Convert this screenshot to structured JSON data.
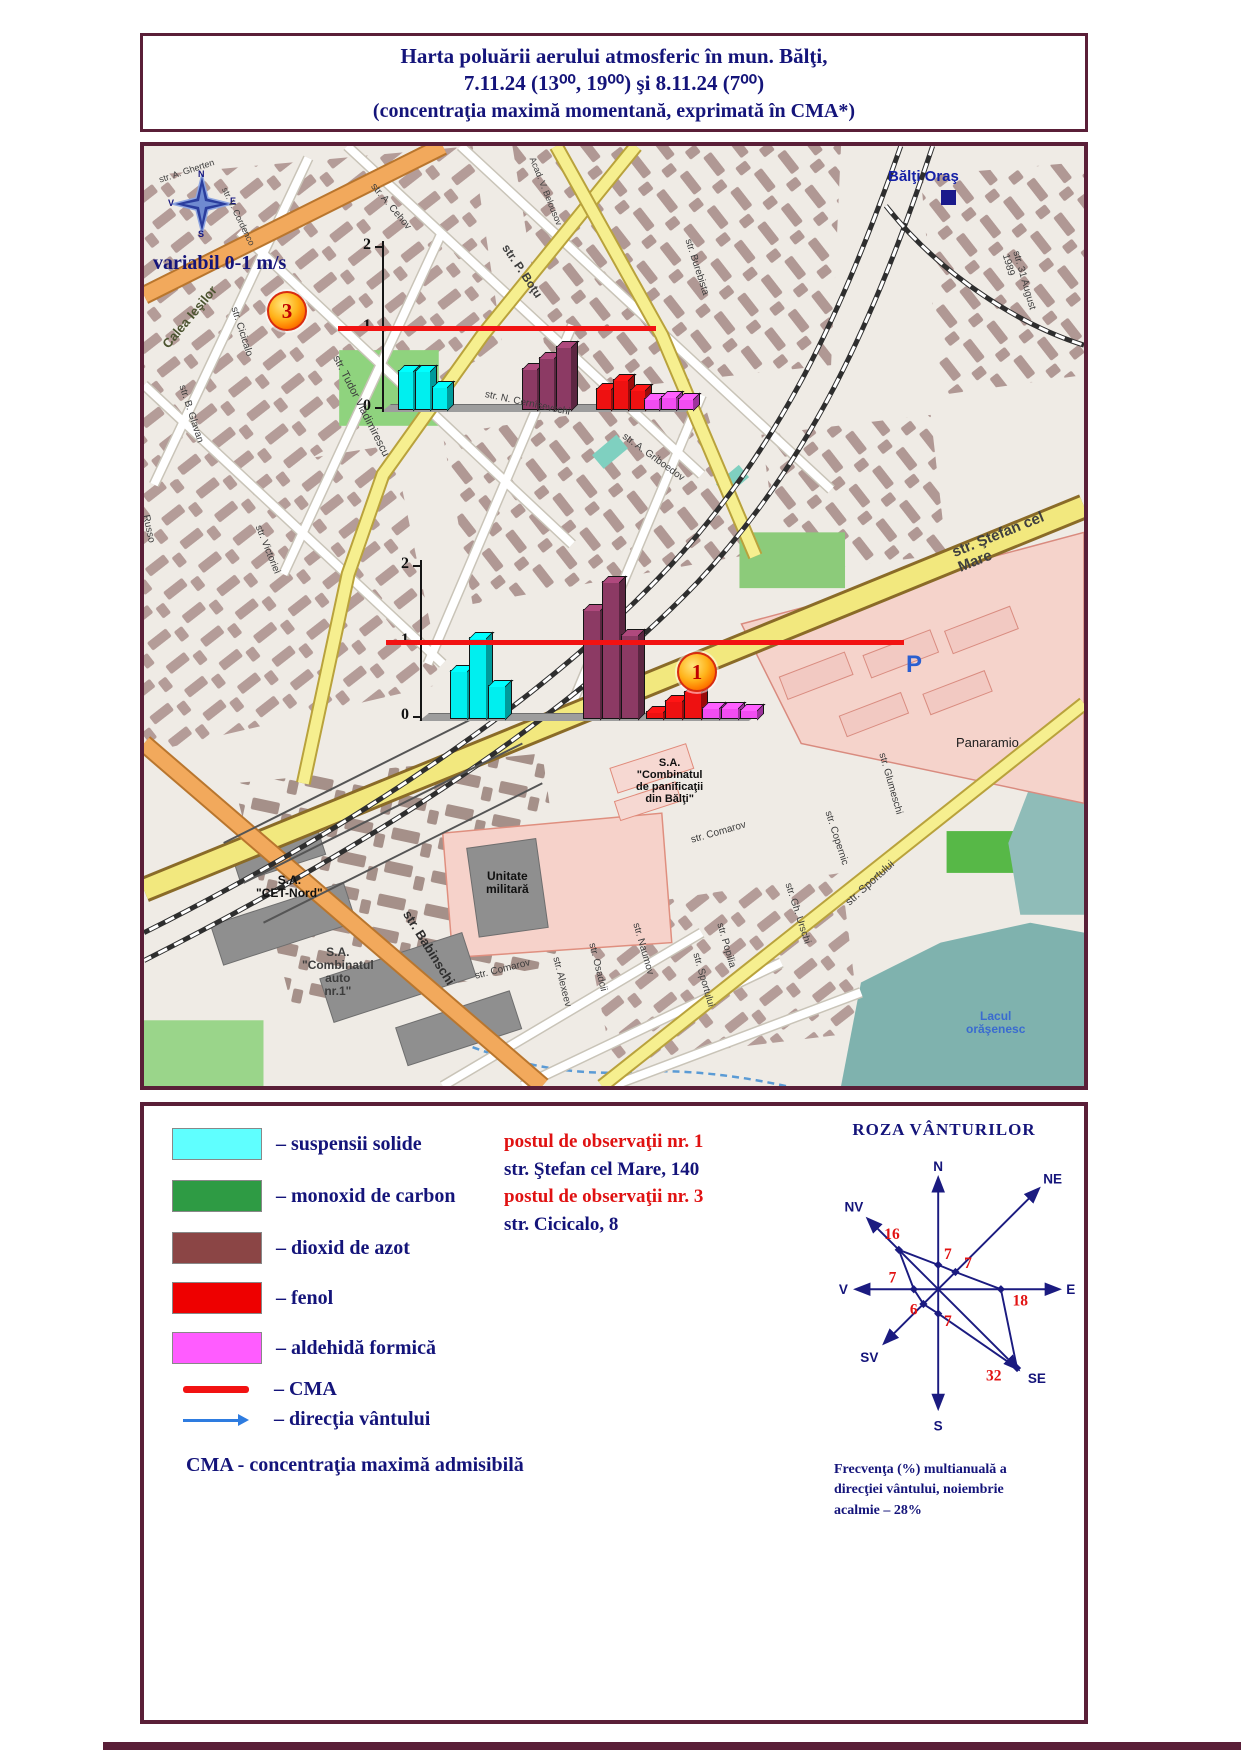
{
  "title": {
    "line1": "Harta poluării aerului atmosferic în mun. Bălţi,",
    "line2": "7.11.24  (13⁰⁰, 19⁰⁰) şi  8.11.24 (7⁰⁰)",
    "line3": "(concentraţia maximă momentană, exprimată în CMA*)"
  },
  "map": {
    "city_label": "Bălţi Oraş",
    "wind_note": "variabil 0-1 m/s",
    "compass": {
      "n": "N",
      "e": "E",
      "s": "S",
      "v": "V"
    },
    "stations": [
      {
        "id": "3",
        "x": 123,
        "y": 145
      },
      {
        "id": "1",
        "x": 533,
        "y": 506
      }
    ],
    "street_labels": [
      {
        "t": "str. A. Gherten",
        "x": 14,
        "y": 30,
        "r": -18,
        "s": 9
      },
      {
        "t": "str. V. Cordenco",
        "x": 84,
        "y": 40,
        "r": 64,
        "s": 9
      },
      {
        "t": "Calea Ieşilor",
        "x": 16,
        "y": 196,
        "r": -50,
        "s": 13,
        "b": 1,
        "c": "#4c5430"
      },
      {
        "t": "str. Cicicalo",
        "x": 94,
        "y": 160,
        "r": 72,
        "s": 10
      },
      {
        "t": "str. B. Glavan",
        "x": 42,
        "y": 238,
        "r": 72,
        "s": 10
      },
      {
        "t": "Russo",
        "x": 6,
        "y": 368,
        "r": 78,
        "s": 10
      },
      {
        "t": "str. Victoriei",
        "x": 118,
        "y": 378,
        "r": 68,
        "s": 10
      },
      {
        "t": "str. Tudor Vladimirescu",
        "x": 196,
        "y": 208,
        "r": 63,
        "s": 11
      },
      {
        "t": "str. A. Cehov",
        "x": 232,
        "y": 36,
        "r": 50,
        "s": 10
      },
      {
        "t": "Acad. V. Belousov",
        "x": 392,
        "y": 10,
        "r": 68,
        "s": 9
      },
      {
        "t": "str. P. Boţu",
        "x": 366,
        "y": 96,
        "r": 56,
        "s": 12,
        "b": 1
      },
      {
        "t": "str. Burebista",
        "x": 548,
        "y": 92,
        "r": 72,
        "s": 10
      },
      {
        "t": "str. A. Griboedov",
        "x": 482,
        "y": 286,
        "r": 36,
        "s": 10
      },
      {
        "t": "str. N. Cernîşevschi",
        "x": 342,
        "y": 244,
        "r": 12,
        "s": 10
      },
      {
        "t": "str. 31 August 1989",
        "x": 876,
        "y": 104,
        "r": 74,
        "s": 10
      },
      {
        "t": "str. Ştefan cel Mare",
        "x": 806,
        "y": 400,
        "r": -22,
        "s": 15,
        "b": 1,
        "c": "#3f3f3f"
      },
      {
        "t": "Panaramio",
        "x": 812,
        "y": 590,
        "r": 0,
        "s": 13,
        "c": "#1d1d1d"
      },
      {
        "t": "P",
        "x": 762,
        "y": 506,
        "r": 0,
        "s": 24,
        "b": 1,
        "c": "#2b5fd0"
      },
      {
        "t": "S.A.\n\"Combinatul\nde panificaţii\ndin Bălţi\"",
        "x": 492,
        "y": 612,
        "r": 0,
        "s": 11,
        "b": 1,
        "c": "#101010",
        "a": "c"
      },
      {
        "t": "Unitate\nmilitară",
        "x": 342,
        "y": 724,
        "r": 0,
        "s": 12,
        "b": 1,
        "c": "#101010",
        "a": "c"
      },
      {
        "t": "S.A.\n\"CET-Nord\"",
        "x": 112,
        "y": 728,
        "r": 0,
        "s": 12,
        "b": 1,
        "c": "#101010",
        "a": "c"
      },
      {
        "t": "str. Babinschi",
        "x": 268,
        "y": 762,
        "r": 58,
        "s": 13,
        "b": 1,
        "c": "#2e2e2e"
      },
      {
        "t": "S.A.\n\"Combinatul\nauto\nnr.1\"",
        "x": 158,
        "y": 800,
        "r": 0,
        "s": 12,
        "b": 1,
        "a": "c"
      },
      {
        "t": "str. Comarov",
        "x": 546,
        "y": 690,
        "r": -16,
        "s": 10
      },
      {
        "t": "str. Copernic",
        "x": 688,
        "y": 664,
        "r": 72,
        "s": 10
      },
      {
        "t": "str. Glumeschi",
        "x": 742,
        "y": 606,
        "r": 74,
        "s": 10
      },
      {
        "t": "str. Gh. Urschi",
        "x": 648,
        "y": 736,
        "r": 72,
        "s": 10
      },
      {
        "t": "str. Sportului",
        "x": 700,
        "y": 754,
        "r": -42,
        "s": 11
      },
      {
        "t": "str. Comarov",
        "x": 330,
        "y": 826,
        "r": -14,
        "s": 10
      },
      {
        "t": "str. Alexeev",
        "x": 416,
        "y": 810,
        "r": 76,
        "s": 10
      },
      {
        "t": "str. Osadcii",
        "x": 452,
        "y": 796,
        "r": 76,
        "s": 10
      },
      {
        "t": "str. Naumov",
        "x": 496,
        "y": 776,
        "r": 74,
        "s": 10
      },
      {
        "t": "str. Popilia",
        "x": 580,
        "y": 776,
        "r": 74,
        "s": 10
      },
      {
        "t": "str. Sportului",
        "x": 556,
        "y": 806,
        "r": 74,
        "s": 10
      },
      {
        "t": "Lacul\norăşenesc",
        "x": 822,
        "y": 864,
        "r": 0,
        "s": 12,
        "b": 1,
        "c": "#3a6bd0",
        "a": "c"
      }
    ]
  },
  "chart_data": [
    {
      "type": "bar",
      "station": "postul de observaţii nr. 3",
      "location": "str. Cicicalo, 8",
      "unit": "CMA",
      "ylim": [
        0,
        2
      ],
      "yticks": [
        0,
        1,
        2
      ],
      "cma_level": 1,
      "categories": [
        "7.11.24 13⁰⁰",
        "7.11.24 19⁰⁰",
        "8.11.24 7⁰⁰"
      ],
      "series": [
        {
          "name": "suspensii solide",
          "color": "#00EFEF",
          "values": [
            0.47,
            0.47,
            0.27
          ]
        },
        {
          "name": "dioxid de azot",
          "color": "#8C3A64",
          "values": [
            0.5,
            0.63,
            0.77
          ]
        },
        {
          "name": "fenol",
          "color": "#EE1111",
          "values": [
            0.25,
            0.36,
            0.24
          ]
        },
        {
          "name": "aldehidă formică",
          "color": "#F24DF2",
          "values": [
            0.12,
            0.15,
            0.12
          ]
        }
      ]
    },
    {
      "type": "bar",
      "station": "postul de observaţii nr. 1",
      "location": "str. Ştefan cel Mare, 140",
      "unit": "CMA",
      "ylim": [
        0,
        2
      ],
      "yticks": [
        0,
        1,
        2
      ],
      "cma_level": 1,
      "categories": [
        "7.11.24 13⁰⁰",
        "7.11.24 19⁰⁰",
        "8.11.24 7⁰⁰"
      ],
      "series": [
        {
          "name": "suspensii solide",
          "color": "#00EFEF",
          "values": [
            0.62,
            1.06,
            0.42
          ]
        },
        {
          "name": "dioxid de azot",
          "color": "#8C3A64",
          "values": [
            1.43,
            1.8,
            1.1
          ]
        },
        {
          "name": "fenol",
          "color": "#EE1111",
          "values": [
            0.08,
            0.22,
            0.35
          ]
        },
        {
          "name": "aldehidă formică",
          "color": "#F24DF2",
          "values": [
            0.13,
            0.13,
            0.1
          ]
        }
      ]
    }
  ],
  "legend": {
    "items": [
      {
        "type": "swatch",
        "color": "#5FFFFF",
        "label": "– suspensii solide"
      },
      {
        "type": "swatch",
        "color": "#2E9B44",
        "label": "– monoxid de carbon"
      },
      {
        "type": "swatch",
        "color": "#8B4545",
        "label": "– dioxid de azot"
      },
      {
        "type": "swatch",
        "color": "#EE0000",
        "label": "– fenol"
      },
      {
        "type": "swatch",
        "color": "#FF5CFF",
        "label": "– aldehidă formică"
      },
      {
        "type": "line",
        "color": "#F21212",
        "label": "– CMA"
      },
      {
        "type": "arrow",
        "color": "#2E7CE0",
        "label": "– direcţia vântului"
      }
    ],
    "note": "CMA  - concentraţia maximă admisibilă",
    "posts": [
      {
        "title": "postul de observaţii nr. 1",
        "address": "str. Ştefan cel Mare, 140"
      },
      {
        "title": "postul de observaţii nr. 3",
        "address": "str. Cicicalo, 8"
      }
    ]
  },
  "wind_rose": {
    "title": "ROZA  VÂNTURILOR",
    "directions": [
      "N",
      "NE",
      "E",
      "SE",
      "S",
      "SV",
      "V",
      "NV"
    ],
    "values": [
      7,
      7,
      18,
      32,
      7,
      6,
      7,
      16
    ],
    "caption": "Frecvenţa (%) multianuală a\ndirecţiei vântului, noiembrie\nacalmie – 28%"
  }
}
